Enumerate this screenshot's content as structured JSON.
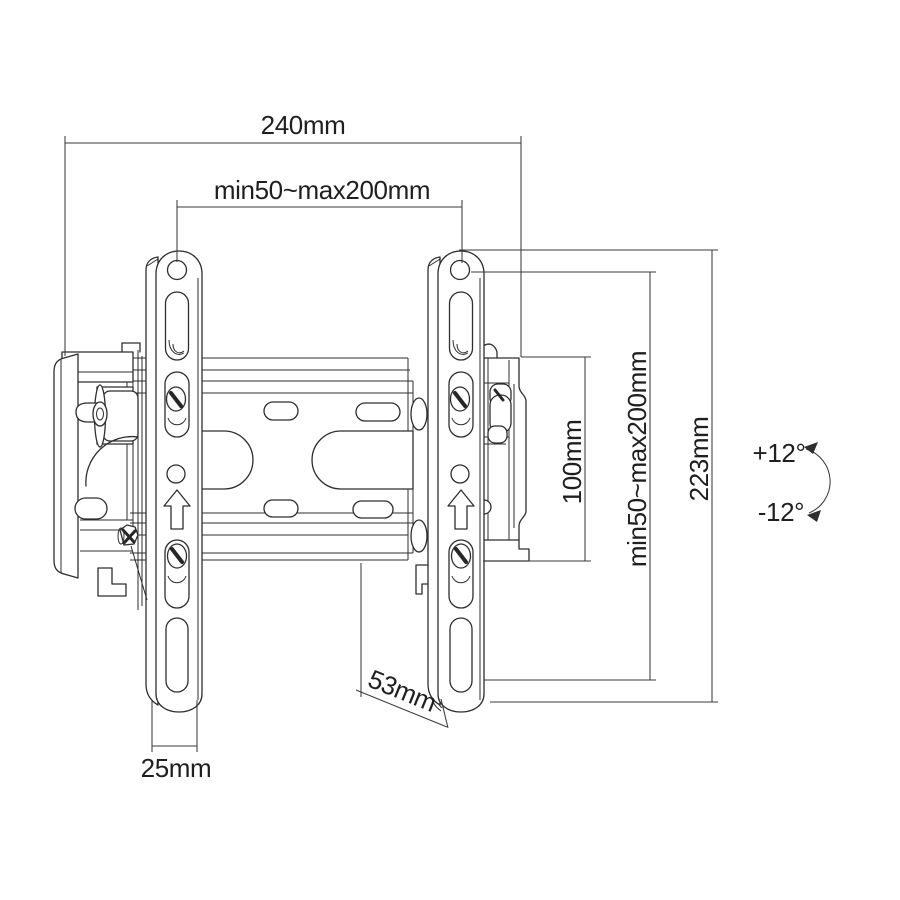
{
  "drawing": {
    "type": "technical-dimension-drawing",
    "subject": "tilting TV wall mount bracket",
    "colors": {
      "ink": "#2e2e2e",
      "background": "#ffffff"
    },
    "dimensions": {
      "overall_width": "240mm",
      "vesa_width_range": "min50~max200mm",
      "plate_height": "100mm",
      "vesa_height_range": "min50~max200mm",
      "overall_height": "223mm",
      "depth": "53mm",
      "arm_width": "25mm"
    },
    "tilt": {
      "up": "+12°",
      "down": "-12°"
    }
  }
}
